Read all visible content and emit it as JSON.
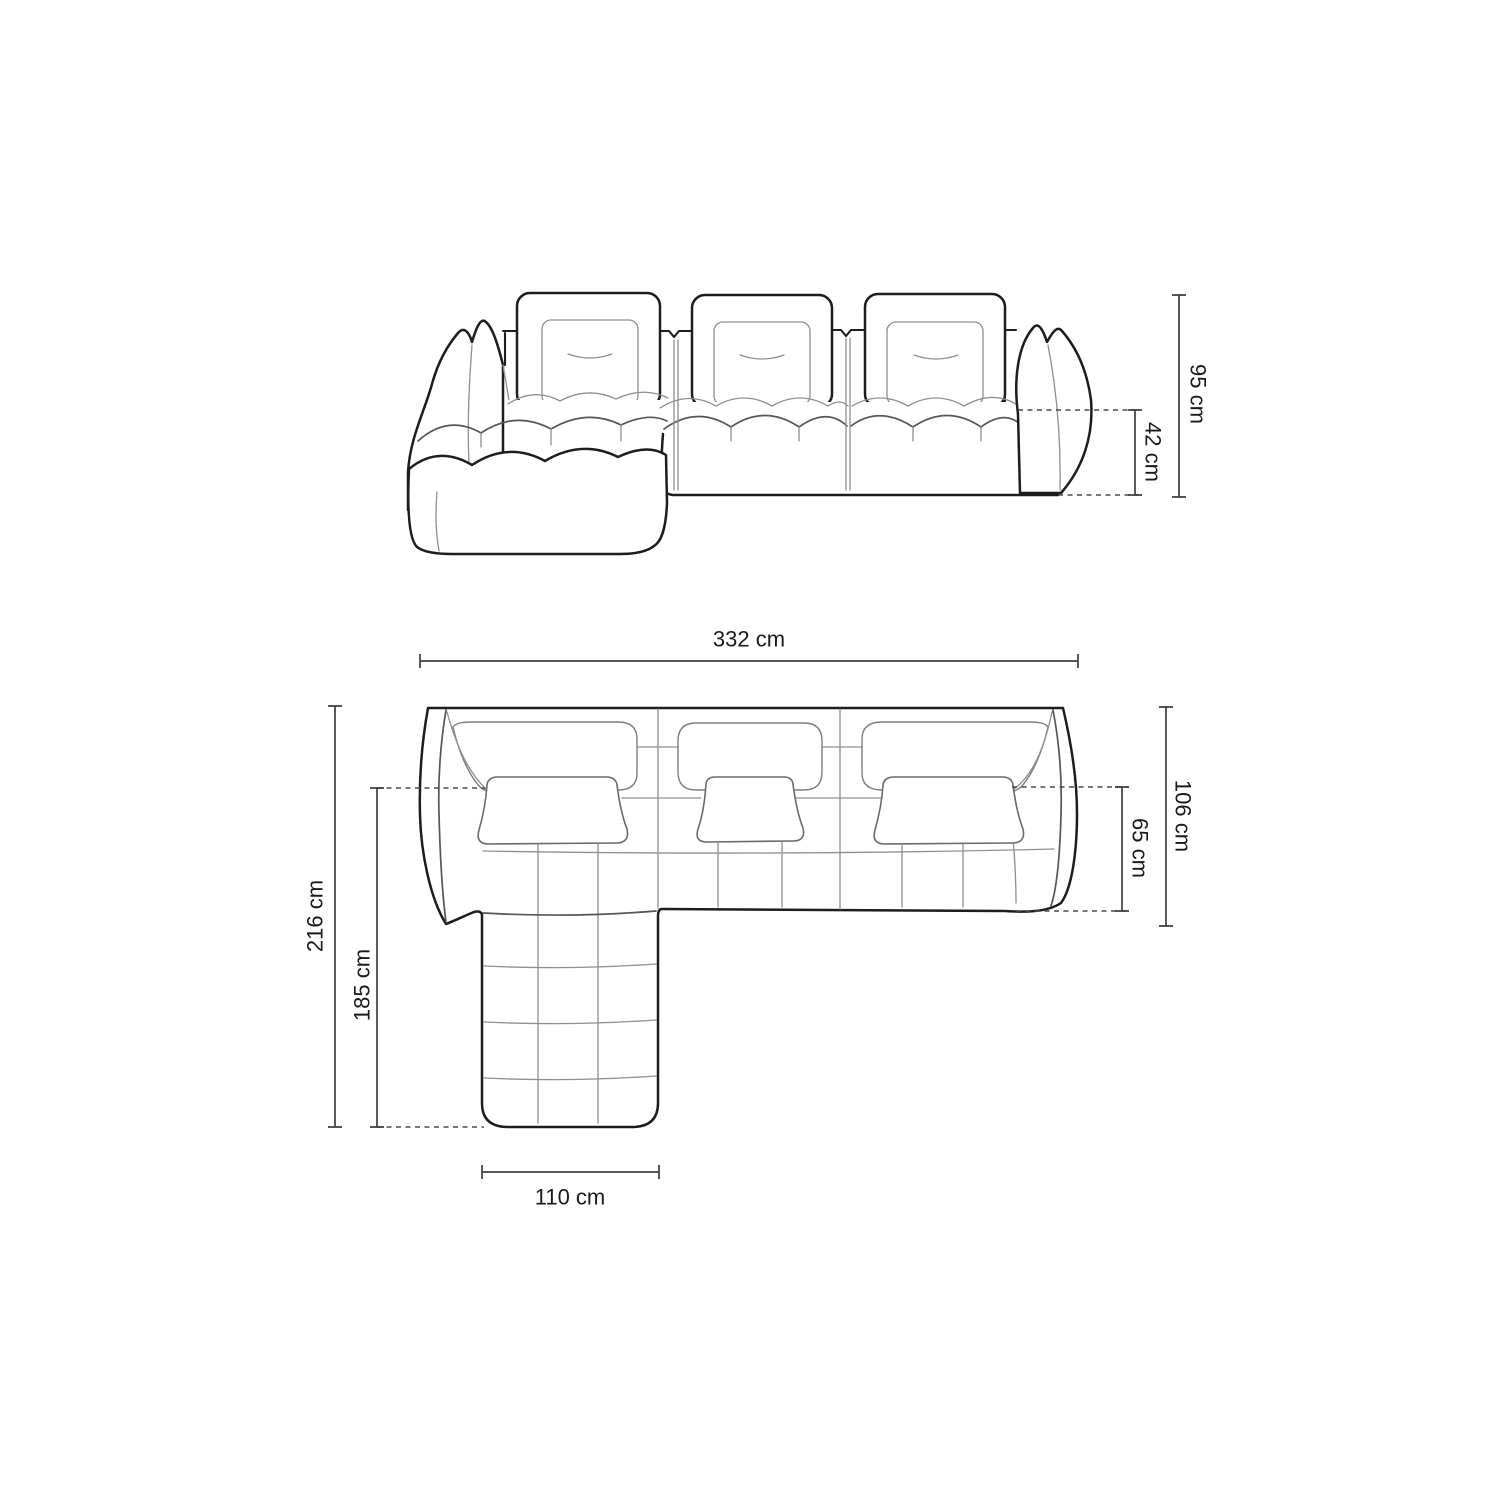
{
  "dims": {
    "front": {
      "total_height": "95 cm",
      "seat_height": "42 cm"
    },
    "plan": {
      "total_width": "332 cm",
      "total_depth": "216 cm",
      "chaise_depth": "185 cm",
      "body_depth": "106 cm",
      "seat_depth": "65 cm",
      "chaise_width": "110 cm"
    }
  },
  "colors": {
    "outline": "#1d1d1d",
    "detail": "#8f8f8f",
    "dimension": "#3e3e3e",
    "label": "#1a1a1a",
    "background": "#ffffff"
  }
}
